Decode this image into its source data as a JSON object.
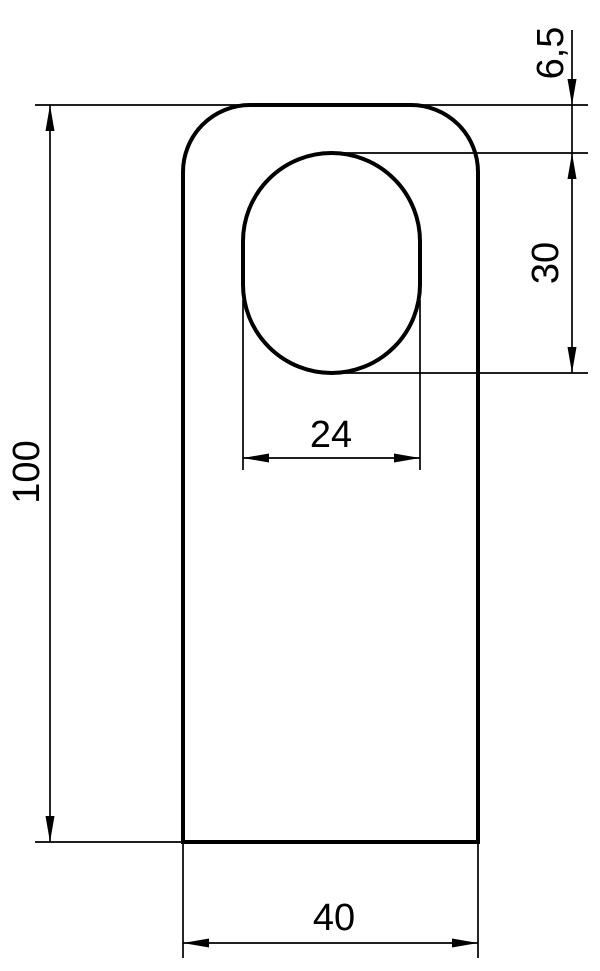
{
  "drawing": {
    "type": "technical-dimension-drawing",
    "background_color": "#ffffff",
    "line_color": "#000000",
    "labels": {
      "total_height": "100",
      "total_width": "40",
      "hole_width": "24",
      "hole_height": "30",
      "hole_top_offset": "6,5"
    }
  }
}
